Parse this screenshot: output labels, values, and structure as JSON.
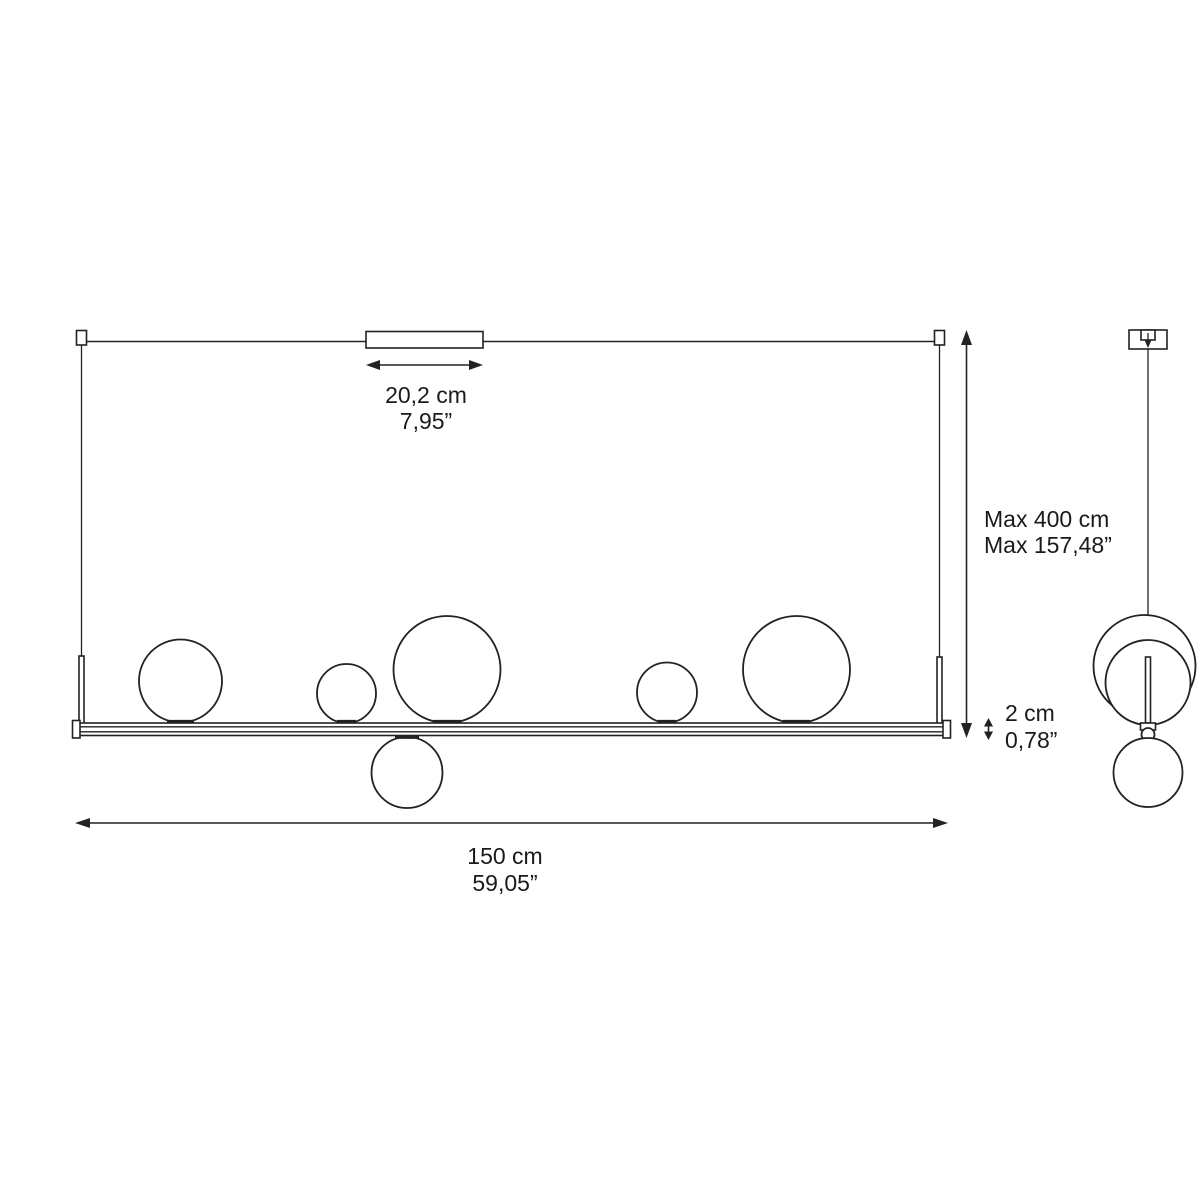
{
  "colors": {
    "background": "#ffffff",
    "line": "#222222",
    "text": "#1a1a1a"
  },
  "annotations": {
    "canopy_width": {
      "cm": "20,2 cm",
      "inch": "7,95”"
    },
    "max_height": {
      "cm": "Max 400 cm",
      "inch": "Max 157,48”"
    },
    "bar_thickness": {
      "cm": "2 cm",
      "inch": "0,78”"
    },
    "total_width": {
      "cm": "150 cm",
      "inch": "59,05”"
    }
  }
}
